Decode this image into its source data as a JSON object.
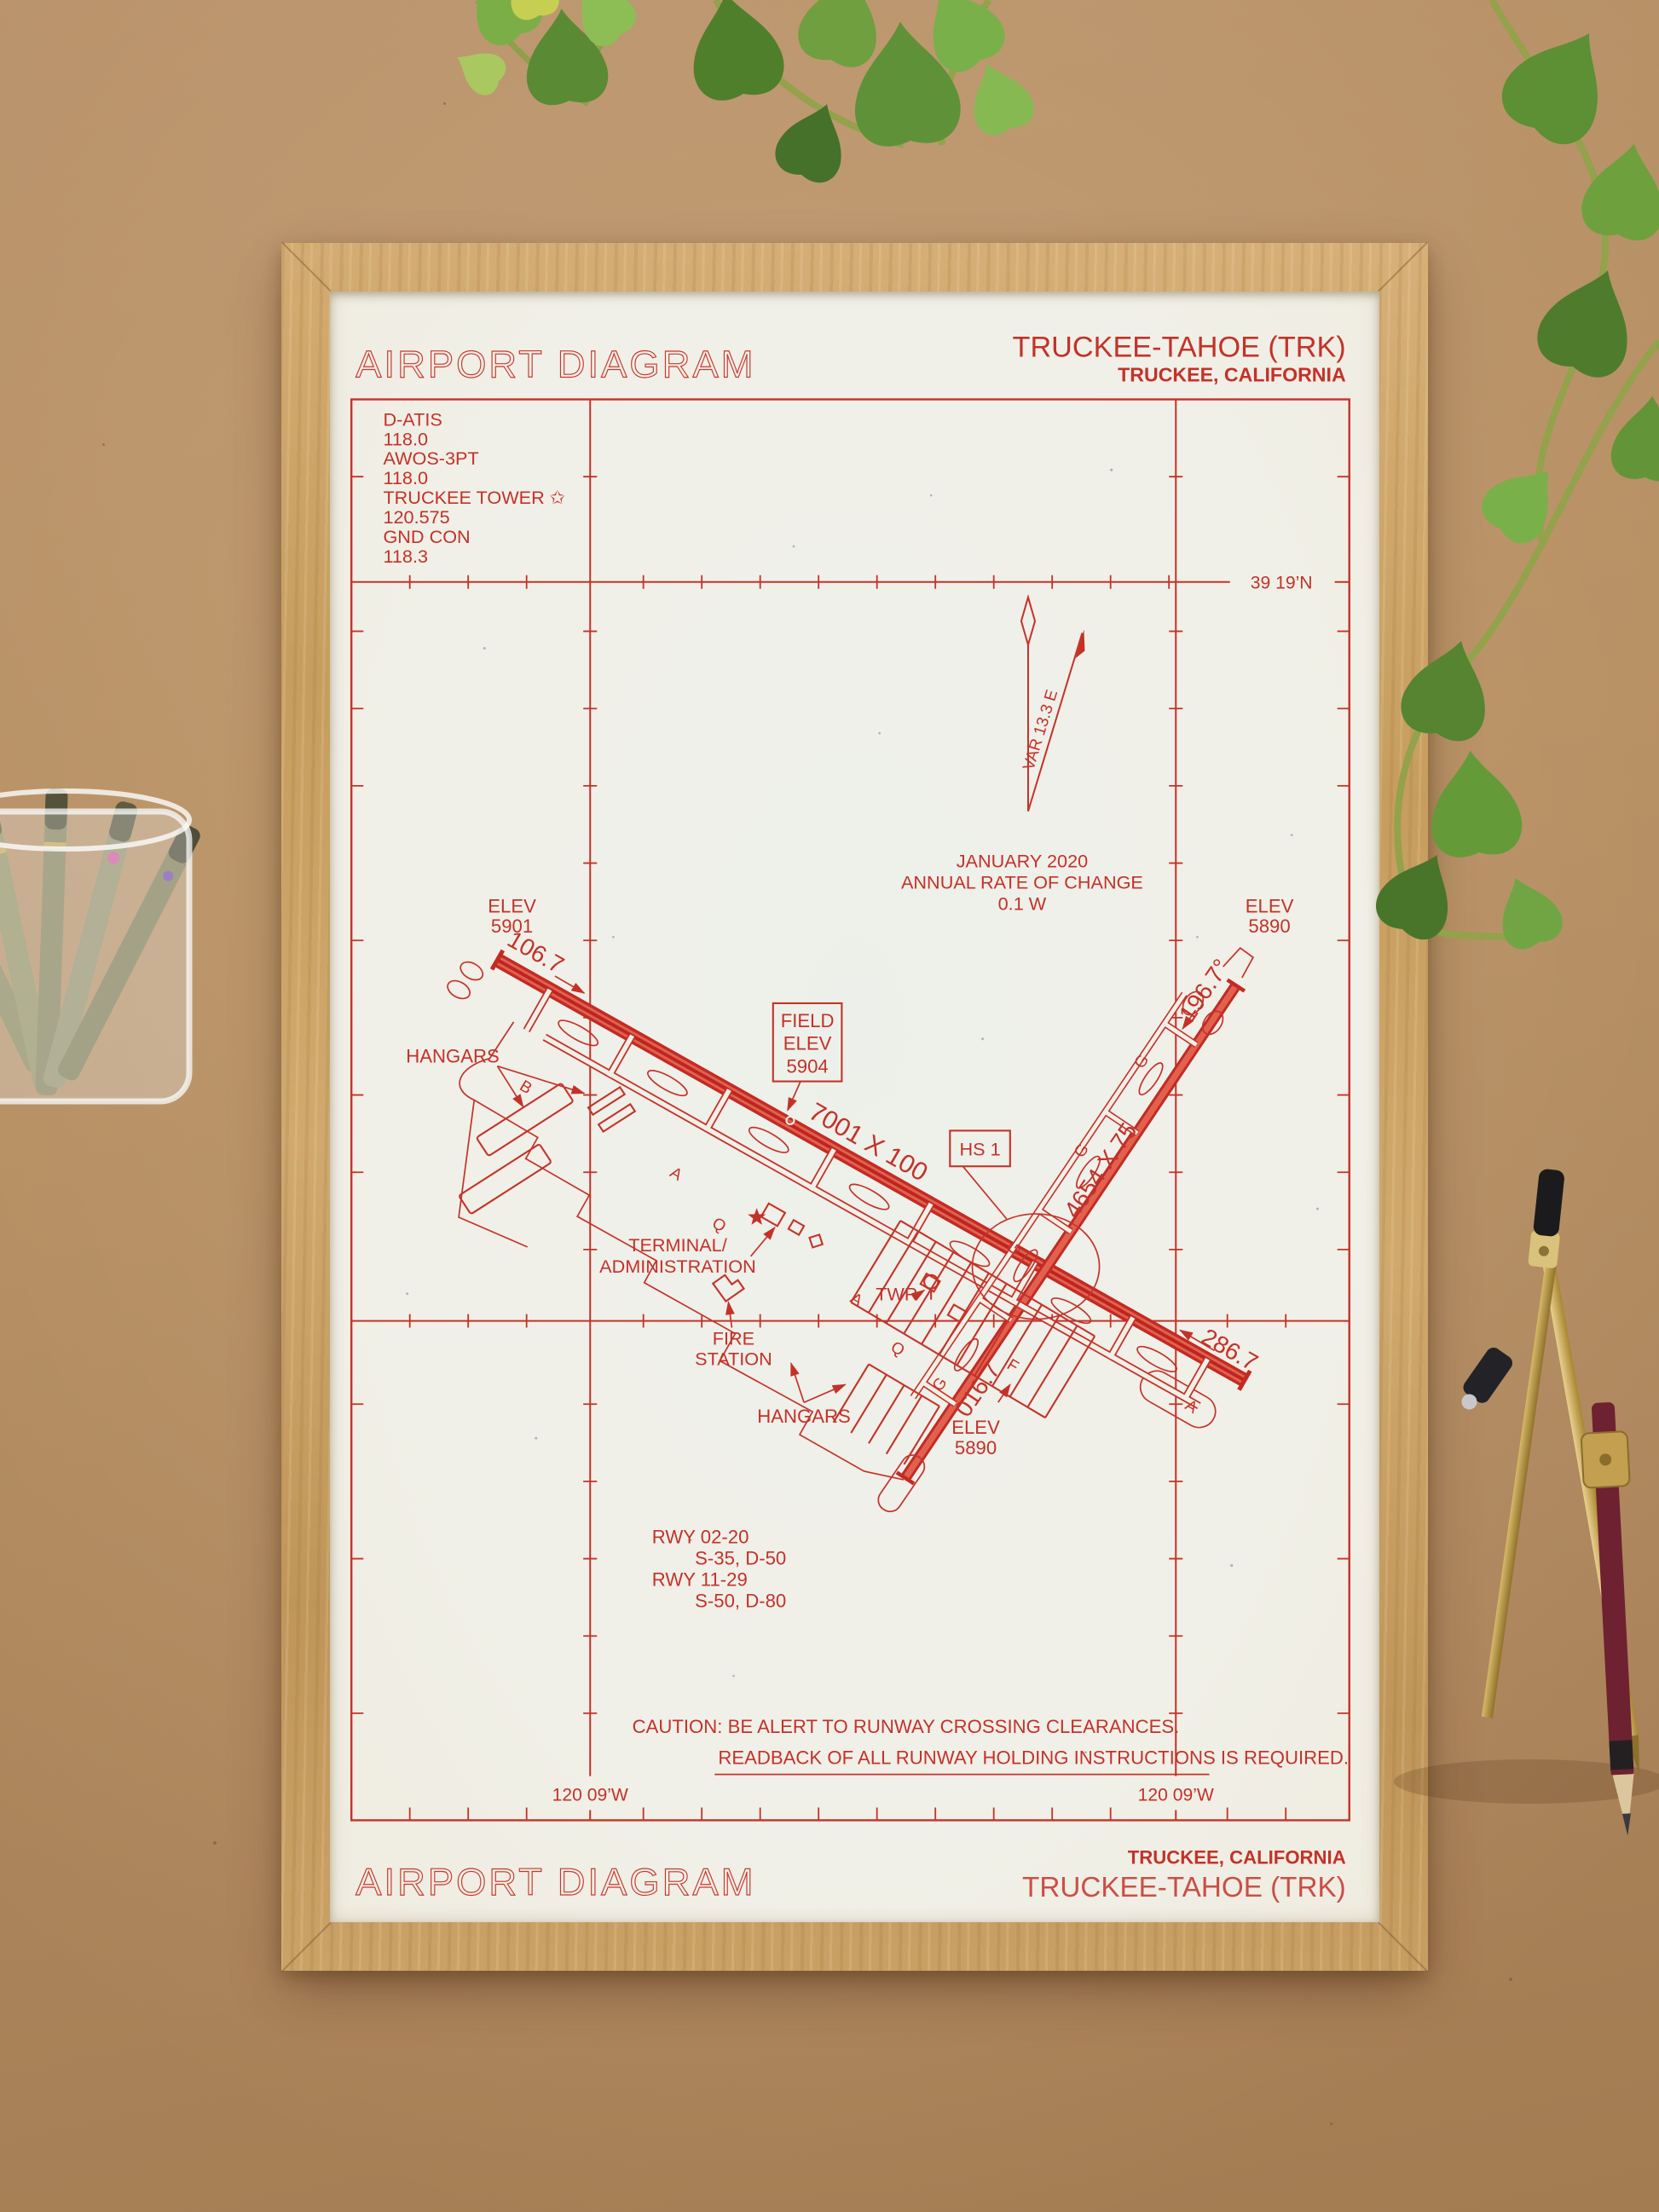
{
  "chart": {
    "header": {
      "title": "AIRPORT DIAGRAM",
      "airport": "TRUCKEE-TAHOE (TRK)",
      "city": "TRUCKEE, CALIFORNIA"
    },
    "footer": {
      "title": "AIRPORT DIAGRAM",
      "city": "TRUCKEE, CALIFORNIA",
      "airport": "TRUCKEE-TAHOE (TRK)"
    },
    "comm_box": {
      "lines": [
        "D-ATIS",
        "118.0",
        "AWOS-3PT",
        "118.0",
        "TRUCKEE TOWER ✩",
        "120.575",
        "GND CON",
        "118.3"
      ]
    },
    "graticule": {
      "latitude": "39 19’N",
      "longitude_left": "120 09’W",
      "longitude_right": "120 09’W"
    },
    "magnetic_variation": {
      "var_label": "VAR 13.3 E",
      "date": "JANUARY 2020",
      "rate_line": "ANNUAL RATE OF CHANGE",
      "rate_value": "0.1 W"
    },
    "field_elevation_box": {
      "line1": "FIELD",
      "line2": "ELEV",
      "line3": "5904"
    },
    "hot_spot": {
      "label": "HS 1"
    },
    "runway_11_29": {
      "dimensions": "7001 X 100",
      "heading_nw": "106.7",
      "heading_se": "286.7",
      "elev_nw": {
        "line1": "ELEV",
        "line2": "5901"
      }
    },
    "runway_02_20": {
      "dimensions": "4654 X 75",
      "heading_ne": "196.7°",
      "heading_sw": "016.7",
      "elev_ne": {
        "line1": "ELEV",
        "line2": "5890"
      },
      "elev_sw": {
        "line1": "ELEV",
        "line2": "5890"
      }
    },
    "labels": {
      "hangars_west": "HANGARS",
      "hangars_south": "HANGARS",
      "terminal_line1": "TERMINAL/",
      "terminal_line2": "ADMINISTRATION",
      "fire_line1": "FIRE",
      "fire_line2": "STATION",
      "tower": "TWR"
    },
    "taxiway_letters": [
      "B",
      "A",
      "Q",
      "A",
      "Q",
      "F",
      "G",
      "G",
      "G",
      "G",
      "A"
    ],
    "runway_data": {
      "lines": [
        "RWY 02-20",
        "S-35, D-50",
        "RWY 11-29",
        "S-50, D-80"
      ]
    },
    "caution": {
      "line1": "CAUTION: BE ALERT TO RUNWAY CROSSING CLEARANCES.",
      "line2": "READBACK OF ALL RUNWAY HOLDING INSTRUCTIONS IS REQUIRED."
    }
  },
  "colors": {
    "ink": "#c33229",
    "paper": "#f1f0e8",
    "frame_oak": "#c8a163",
    "cardboard": "#b28a5c",
    "plant_green": "#5f9136",
    "brass": "#c5a452",
    "pencil_body": "#6e2130"
  }
}
